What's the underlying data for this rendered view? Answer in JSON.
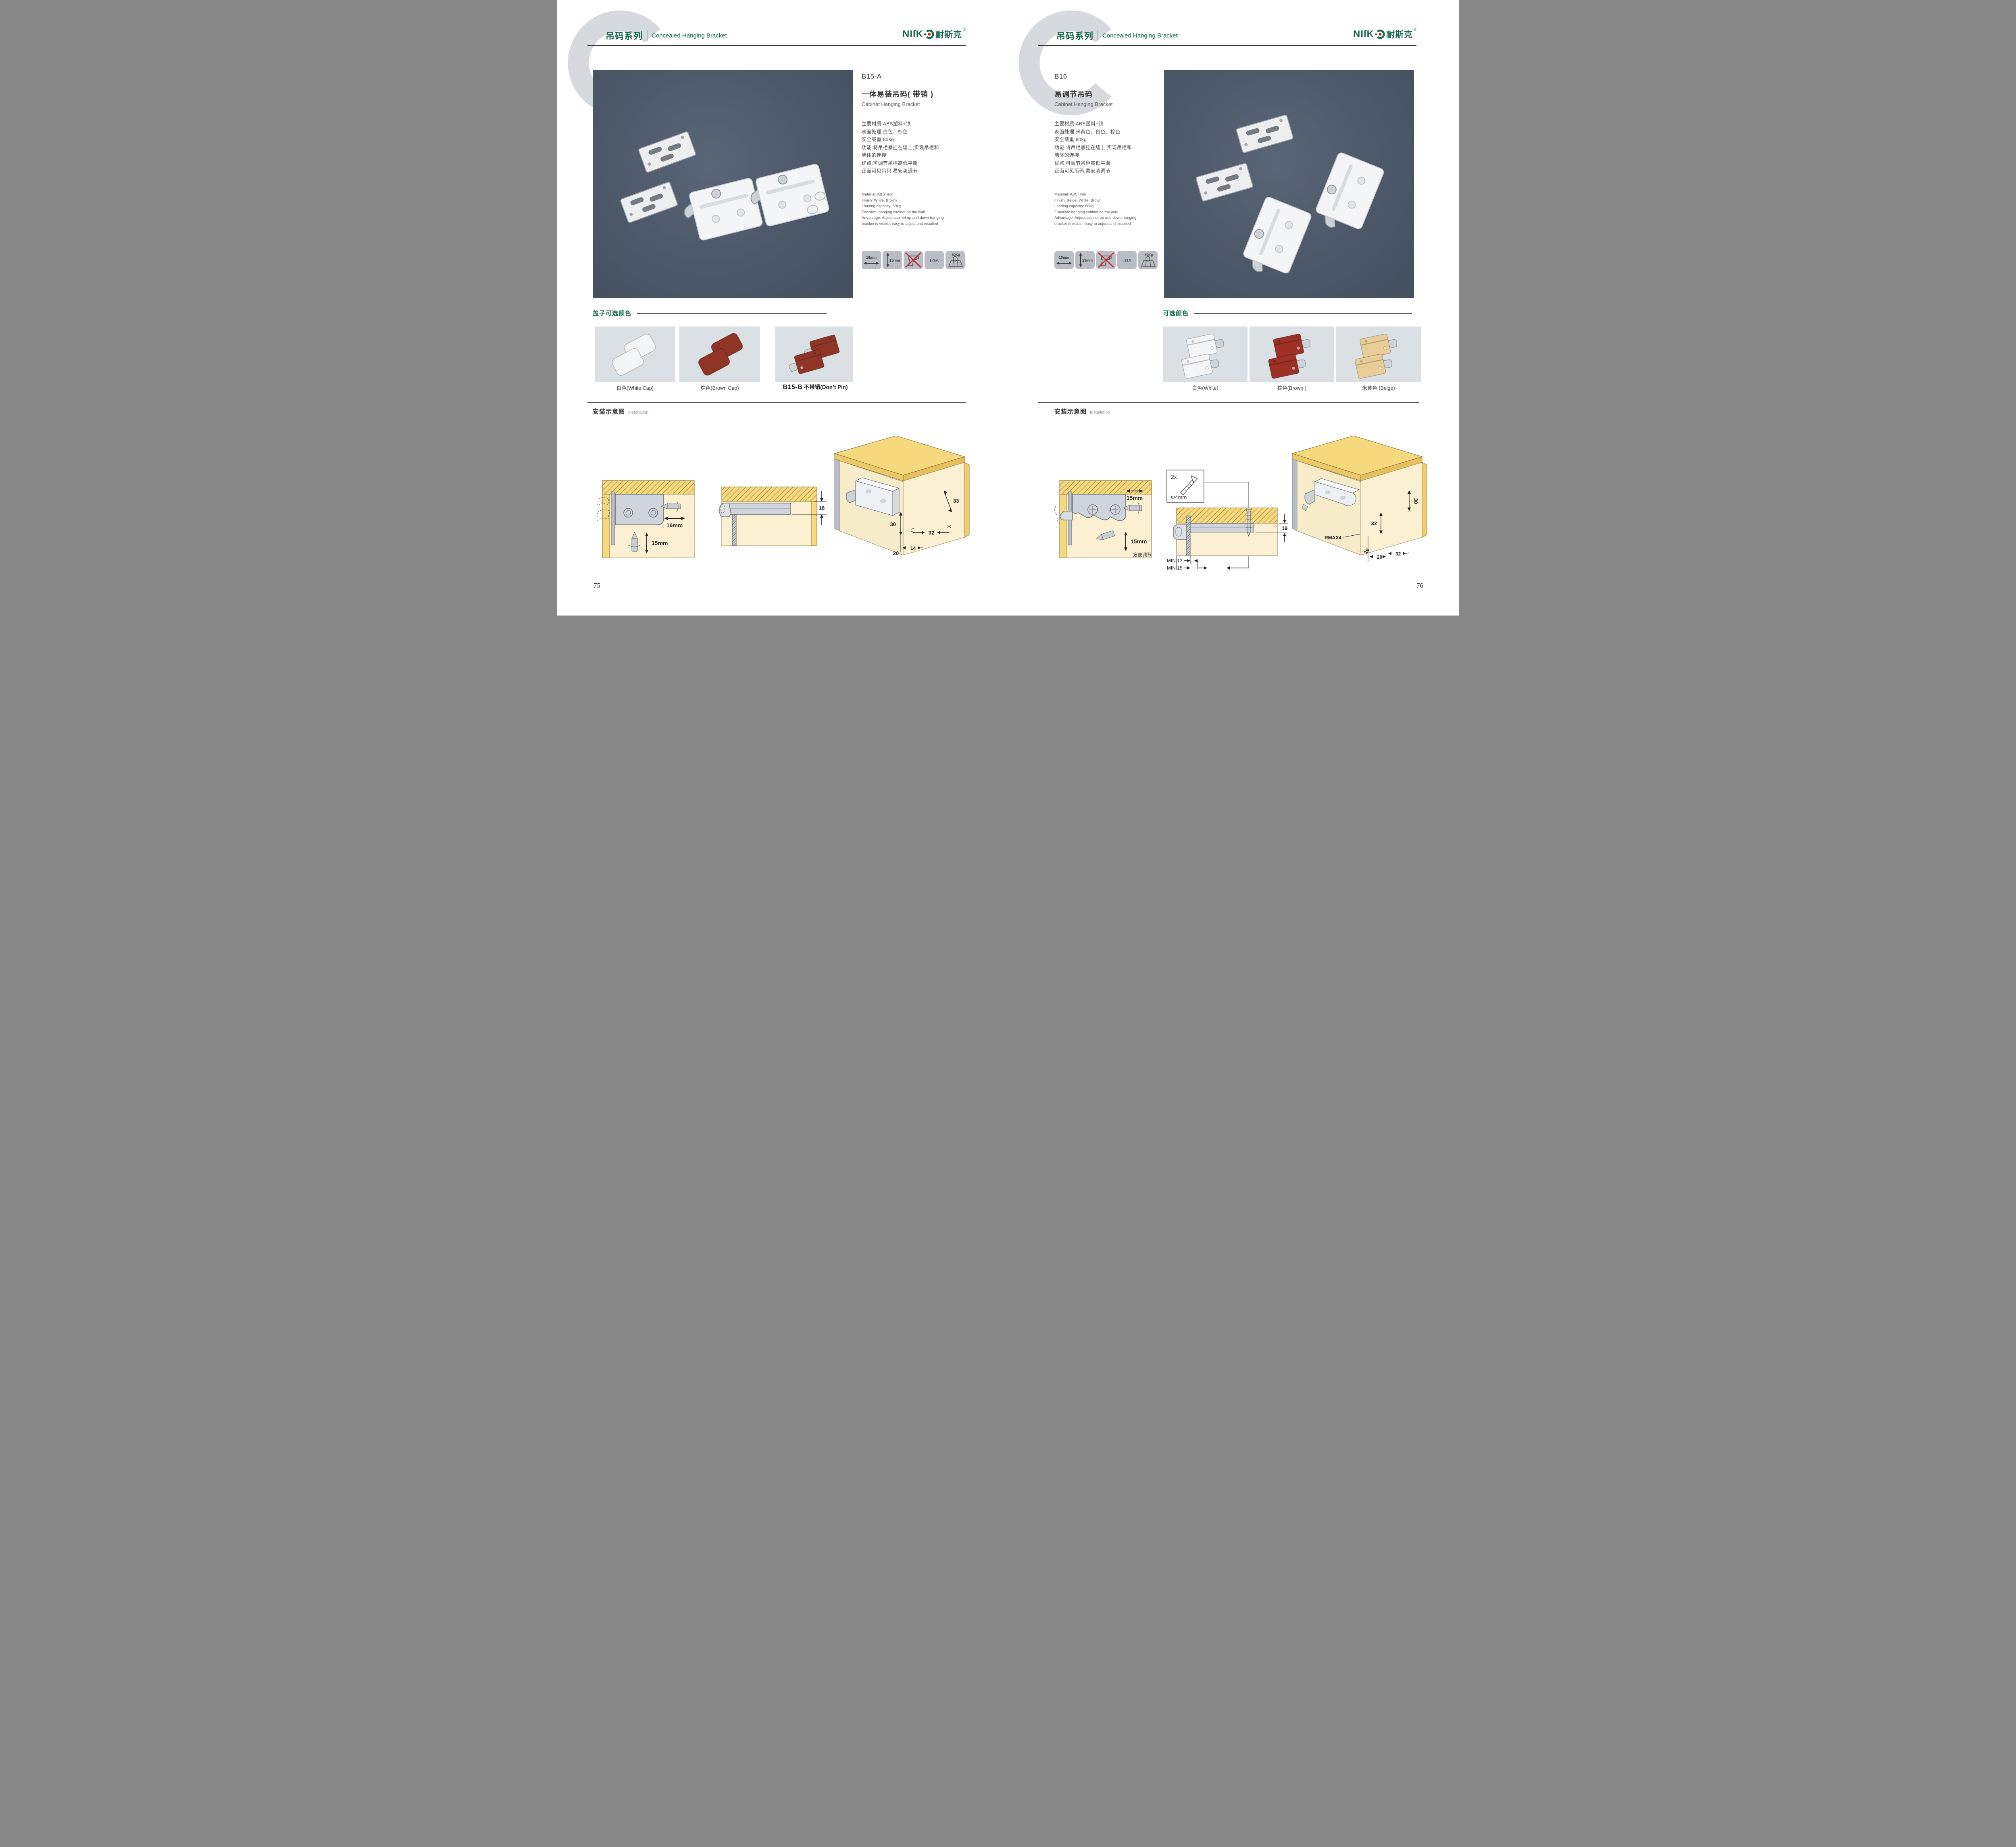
{
  "header": {
    "watermark": "C",
    "series_cn": "吊码系列",
    "series_en": "Concealed Hanging Bracket",
    "brand": {
      "en": "NIſK",
      "cn": "耐斯克",
      "reg": "®"
    }
  },
  "palette": {
    "brand_green": "#15684a",
    "logo_red": "#d8150f",
    "ink": "#3a3a3a",
    "photo_bg": "#4e5a6a",
    "card_bg": "#dbe0e5",
    "tile_bg": "#b8bec4",
    "wood": "#f7d97d",
    "panel": "#fbf0d2",
    "rule_dark": "#3b3b3b"
  },
  "pages": [
    {
      "page_number": "75",
      "product": {
        "code": "B15-A",
        "name_cn": "一体易装吊码( 带销 )",
        "name_en": "Cabinet Hanging Bracket",
        "specs_cn": [
          "主要材质:ABS塑料+铁",
          "表面处理:白色、棕色",
          "安全载重:80kg",
          "功能:将吊柜悬挂在墙上,实现吊柜和",
          "墙体的连接",
          "优点:可调节吊柜高低平衡",
          "正面可见吊码,易安装调节"
        ],
        "specs_en": [
          "Material: ABS+iron",
          "Finish: White, Brown",
          "Loading capacity: 80kg",
          "Function: hanging cabinet on the wall",
          "Advantage: Adjust cabinet up and down hanging",
          "bracket is visible, easy to adjust and installed"
        ],
        "icons": [
          {
            "name": "panel-width-icon",
            "label": "16mm"
          },
          {
            "name": "panel-height-icon",
            "label": "15mm"
          },
          {
            "name": "no-drill-icon",
            "label": ""
          },
          {
            "name": "cert-icon",
            "label": "LGA"
          },
          {
            "name": "load-icon",
            "label": "80Kg"
          }
        ]
      },
      "colors": {
        "title": "盖子可选颜色",
        "options": [
          {
            "label": "白色(White Cap)",
            "hex": "#f3f5f6"
          },
          {
            "label": "棕色(Brown Cap)",
            "hex": "#8e3526"
          },
          {
            "code": "B15-B",
            "label": "不带销(Don’t Pin)",
            "hex": "#8e3526"
          }
        ]
      },
      "installation": {
        "title_cn": "安装示意图",
        "title_en": "Installation",
        "d1": {
          "w": "16mm",
          "h": "15mm"
        },
        "d2": {
          "dim": "18"
        },
        "d3": {
          "a": "33",
          "b": "30",
          "c": "32",
          "d": "20",
          "e": "14"
        }
      }
    },
    {
      "page_number": "76",
      "product": {
        "code": "B16",
        "name_cn": "易调节吊码",
        "name_en": "Cabinet Hanging Bracket",
        "specs_cn": [
          "主要材质:ABS塑料+铁",
          "表面处理:米黄色、白色、棕色",
          "安全载重:80kg",
          "功能:将吊柜悬挂在墙上,实现吊柜和",
          "墙体的连接",
          "优点:可调节吊柜高低平衡",
          "正面可见吊码,易安装调节"
        ],
        "specs_en": [
          "Material: ABS+iron",
          "Finish: Beige, White, Brown",
          "Loading capacity: 80kg",
          "Function: hanging cabinet on the wall",
          "Advantage: Adjust cabinet up and down hanging",
          "bracket is visible, easy to adjust and installed"
        ],
        "icons": [
          {
            "name": "panel-width-icon",
            "label": "10mm"
          },
          {
            "name": "panel-height-icon",
            "label": "15mm"
          },
          {
            "name": "no-drill-icon",
            "label": ""
          },
          {
            "name": "cert-icon",
            "label": "LGA"
          },
          {
            "name": "load-icon",
            "label": "80Kg"
          }
        ]
      },
      "colors": {
        "title": "可选颜色",
        "options": [
          {
            "label": "白色(White)",
            "hex": "#f3f5f6"
          },
          {
            "label": "棕色(Brown )",
            "hex": "#9c3024"
          },
          {
            "label": "米黄色 (Beige)",
            "hex": "#e8cd96"
          }
        ]
      },
      "installation": {
        "title_cn": "安装示意图",
        "title_en": "Installation",
        "d1": {
          "w": "15mm",
          "h": "15mm",
          "note": "方便调节"
        },
        "d2": {
          "qty": "2x",
          "dia": "Φ4mm",
          "dim": "19",
          "min1": "MIN.12",
          "min2": "MIN.15"
        },
        "d3": {
          "a": "30",
          "b": "32",
          "r": "RMAX4",
          "c": "19",
          "d": "20",
          "e": "32"
        }
      }
    }
  ]
}
